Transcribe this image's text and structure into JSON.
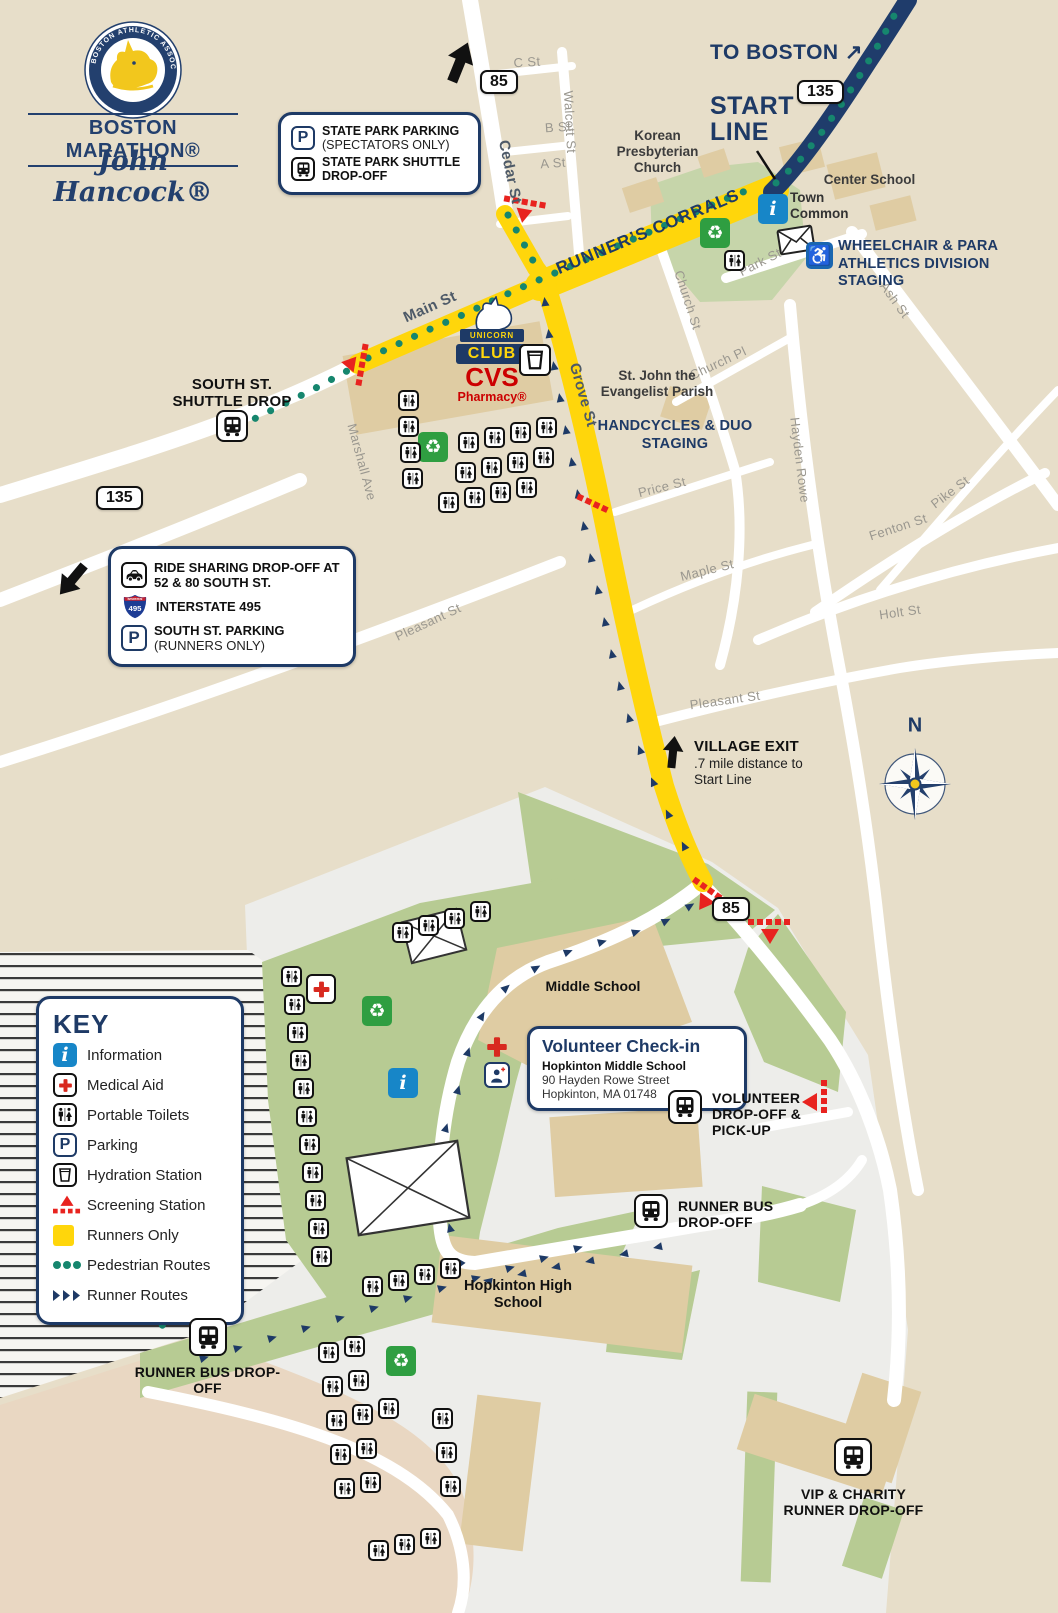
{
  "branding": {
    "association_arc": "BOSTON ATHLETIC ASSOCIATION",
    "wordmark": "BOSTON MARATHON®",
    "sponsor": "John Hancock®"
  },
  "routes": {
    "to_boston": "TO BOSTON ↗",
    "start_line": "START LINE",
    "runners_corrals": "RUNNER’S CORRALS",
    "compass_n": "N"
  },
  "shields": {
    "r85": "85",
    "r135": "135",
    "i495_top": "INTERSTATE",
    "i495_num": "495"
  },
  "streets": {
    "c_st": "C St",
    "b_st": "B St",
    "a_st": "A St",
    "walcott": "Walcott St",
    "cedar": "Cedar St",
    "main": "Main St",
    "marshall": "Marshall Ave",
    "grove": "Grove St",
    "church_st": "Church St",
    "church_pl": "Church Pl",
    "park": "Park St",
    "ash": "Ash St",
    "hayden_rowe": "Hayden Rowe",
    "fenton": "Fenton St",
    "pike": "Pike St",
    "price": "Price St",
    "maple": "Maple St",
    "holt": "Holt St",
    "pleasant_w": "Pleasant St",
    "pleasant_e": "Pleasant St"
  },
  "places": {
    "korean_church": "Korean Presbyterian Church",
    "center_school": "Center School",
    "town_common": "Town Common",
    "st_john": "St. John the Evangelist Parish",
    "middle_school": "Middle School",
    "high_school": "Hopkinton High School"
  },
  "staging": {
    "wheelchair": "WHEELCHAIR & PARA ATHLETICS DIVISION STAGING",
    "handcycles": "HANDCYCLES & DUO STAGING"
  },
  "callouts": {
    "state_park": {
      "parking": "STATE PARK PARKING",
      "parking_sub": "(SPECTATORS ONLY)",
      "shuttle": "STATE PARK SHUTTLE DROP-OFF"
    },
    "ride_share": {
      "dropoff": "RIDE SHARING DROP-OFF AT 52 & 80 SOUTH ST.",
      "interstate": "INTERSTATE 495",
      "parking": "SOUTH ST. PARKING",
      "parking_sub": "(RUNNERS ONLY)"
    },
    "volunteer": {
      "title": "Volunteer Check-in",
      "line1": "Hopkinton Middle School",
      "line2": "90 Hayden Rowe Street",
      "line3": "Hopkinton, MA 01748"
    }
  },
  "markers": {
    "south_shuttle": "SOUTH ST. SHUTTLE DROP",
    "village_exit_title": "VILLAGE EXIT",
    "village_exit_sub": ".7 mile distance to Start Line",
    "volunteer_dropoff": "VOLUNTEER DROP-OFF & PICK-UP",
    "runner_bus": "RUNNER BUS DROP-OFF",
    "runner_bus_sw": "RUNNER BUS DROP-OFF",
    "vip": "VIP & CHARITY RUNNER DROP-OFF"
  },
  "key": {
    "title": "KEY",
    "items": [
      {
        "label": "Information"
      },
      {
        "label": "Medical Aid"
      },
      {
        "label": "Portable Toilets"
      },
      {
        "label": "Parking"
      },
      {
        "label": "Hydration Station"
      },
      {
        "label": "Screening Station"
      },
      {
        "label": "Runners Only"
      },
      {
        "label": "Pedestrian Routes"
      },
      {
        "label": "Runner Routes"
      }
    ]
  },
  "logos": {
    "unicorn_top": "UNICORN",
    "unicorn_bottom": "CLUB",
    "cvs": "CVS",
    "cvs_sub": "Pharmacy®"
  },
  "icons": {
    "info_glyph": "i",
    "parking_glyph": "P",
    "recycle_glyph": "♻",
    "wheelchair_glyph": "♿"
  },
  "colors": {
    "navy": "#1e3a66",
    "yellow": "#ffd60b",
    "teal": "#16866e",
    "red": "#e8231f",
    "green": "#b7cb93",
    "beige": "#e7dec9"
  }
}
